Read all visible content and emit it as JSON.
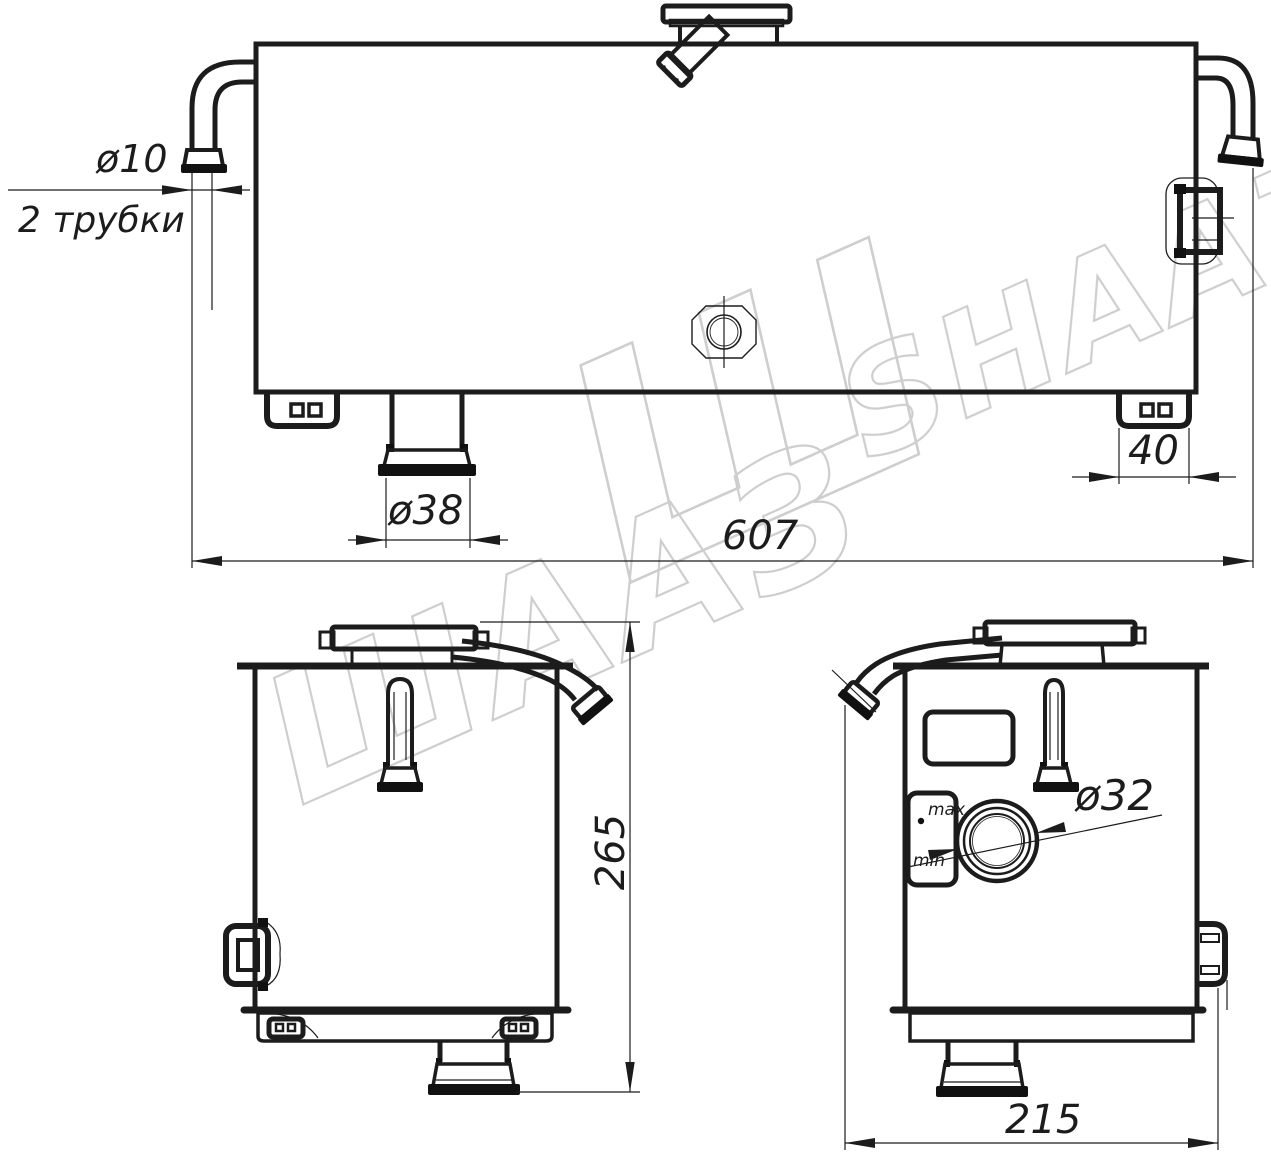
{
  "drawing": {
    "title": "Expansion tank technical drawing (three views)",
    "watermark": {
      "cyrillic": "ШААЗ",
      "glyph": "Ш",
      "latin": "SHAAZ",
      "color": "#c9c9c9"
    },
    "dims": {
      "tube_dia": "ø10",
      "tube_note": "2 трубки",
      "overall_length": "607",
      "foot_width": "40",
      "drain_dia": "ø38",
      "height": "265",
      "filler_dia": "ø32",
      "depth": "215"
    },
    "labels": {
      "max": "max",
      "min": "min"
    },
    "colors": {
      "line": "#1c1c1c",
      "background": "#ffffff"
    }
  }
}
